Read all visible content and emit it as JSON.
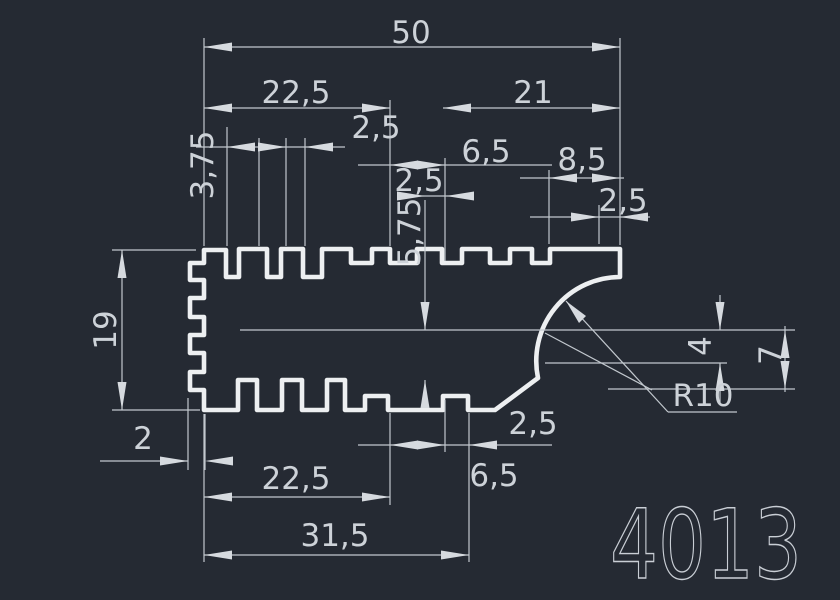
{
  "drawing": {
    "part_number": "4013",
    "background_color": "#252A33",
    "profile_color": "#EDEFF1",
    "dimension_color": "#C2C8CE",
    "text_color": "#CDD2D8",
    "text_size": 31,
    "part_number_size": 96,
    "radius_label": "R10",
    "dimensions": [
      {
        "id": "dim-50",
        "value": "50",
        "x": 411,
        "y": 43,
        "rot": 0
      },
      {
        "id": "dim-22-5-top",
        "value": "22,5",
        "x": 296,
        "y": 103,
        "rot": 0
      },
      {
        "id": "dim-21",
        "value": "21",
        "x": 533,
        "y": 103,
        "rot": 0
      },
      {
        "id": "dim-2-5-topleft",
        "value": "2,5",
        "x": 376,
        "y": 138,
        "rot": 0
      },
      {
        "id": "dim-3-75",
        "value": "3,75",
        "x": 213,
        "y": 165,
        "rot": -90
      },
      {
        "id": "dim-6-5-top",
        "value": "6,5",
        "x": 486,
        "y": 162,
        "rot": 0
      },
      {
        "id": "dim-8-5",
        "value": "8,5",
        "x": 582,
        "y": 170,
        "rot": 0
      },
      {
        "id": "dim-2-5-mid",
        "value": "2,5",
        "x": 419,
        "y": 191,
        "rot": 0
      },
      {
        "id": "dim-2-5-right",
        "value": "2,5",
        "x": 623,
        "y": 211,
        "rot": 0
      },
      {
        "id": "dim-5-75",
        "value": "5,75",
        "x": 420,
        "y": 232,
        "rot": -90
      },
      {
        "id": "dim-19",
        "value": "19",
        "x": 116,
        "y": 330,
        "rot": -90
      },
      {
        "id": "dim-4",
        "value": "4",
        "x": 711,
        "y": 346,
        "rot": -90
      },
      {
        "id": "dim-7",
        "value": "7",
        "x": 781,
        "y": 355,
        "rot": -90
      },
      {
        "id": "dim-R10",
        "value": "R10",
        "x": 703,
        "y": 406,
        "rot": 0
      },
      {
        "id": "dim-2-5-bottom",
        "value": "2,5",
        "x": 533,
        "y": 434,
        "rot": 0
      },
      {
        "id": "dim-2",
        "value": "2",
        "x": 143,
        "y": 449,
        "rot": 0
      },
      {
        "id": "dim-6-5-bottom",
        "value": "6,5",
        "x": 494,
        "y": 486,
        "rot": 0
      },
      {
        "id": "dim-22-5-bottom",
        "value": "22,5",
        "x": 296,
        "y": 489,
        "rot": 0
      },
      {
        "id": "dim-31-5",
        "value": "31,5",
        "x": 335,
        "y": 546,
        "rot": 0
      }
    ]
  }
}
